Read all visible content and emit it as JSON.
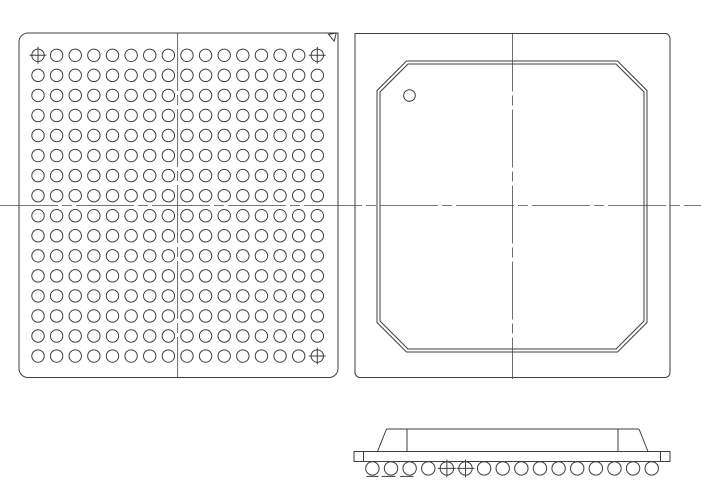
{
  "drawing": {
    "canvas": {
      "width": 701,
      "height": 495,
      "background": "#ffffff"
    },
    "stroke_color": "#3f3f3f",
    "centerline_color": "#4a4a4a",
    "line_width": 1,
    "centerline_width": 0.8,
    "centerline_dash": "58 4 10 4",
    "h_centerline": {
      "y": 205.6,
      "x1": 0,
      "x2": 701
    },
    "bottom_view": {
      "outline": {
        "x1": 19,
        "y1": 33,
        "x2": 338,
        "y2": 377.5,
        "corner_radius": 9,
        "sharp_corner": "tr"
      },
      "pin1_triangle": [
        [
          328.5,
          34.2
        ],
        [
          336.2,
          33.2
        ],
        [
          334.2,
          41.2
        ]
      ],
      "grid": {
        "cols": 16,
        "rows": 16,
        "x0": 38,
        "y0": 55.3,
        "dx": 18.62,
        "dy": 20.05,
        "ball_radius": 6.2
      },
      "crosshair_balls": [
        [
          0,
          0
        ],
        [
          0,
          15
        ],
        [
          15,
          15
        ]
      ],
      "crosshair_overhang": 2.2,
      "v_centerline": {
        "x": 177.65,
        "y1": 33,
        "y2": 377.5
      }
    },
    "top_view": {
      "outline": {
        "x1": 355,
        "y1": 33.5,
        "x2": 670,
        "y2": 377.5,
        "corner_radius": 5,
        "sharp_corner": "tl"
      },
      "mold_octagon_outer": {
        "x1": 377,
        "y1": 61,
        "x2": 647,
        "y2": 352,
        "chamfer": 29.5
      },
      "mold_octagon_inner": {
        "x1": 380,
        "y1": 64,
        "x2": 644,
        "y2": 349,
        "chamfer": 28
      },
      "pin1_dot": {
        "cx": 409.5,
        "cy": 95.5,
        "r": 5.8
      },
      "v_centerline": {
        "x": 512.5,
        "y1": 33.5,
        "y2": 379
      }
    },
    "side_view": {
      "substrate": {
        "x1": 354,
        "y1": 451.5,
        "x2": 670,
        "y2": 461.5
      },
      "substrate_end_lines_x": [
        363.5,
        660.5
      ],
      "mold_top": {
        "y": 429,
        "x1": 386.5,
        "x2": 639
      },
      "mold_slants": [
        [
          377.5,
          451.5,
          386.5,
          429
        ],
        [
          639,
          429,
          648,
          451.5
        ]
      ],
      "mold_edge_lines": [
        [
          407,
          429,
          407,
          451.5
        ],
        [
          618,
          429,
          618,
          451.5
        ]
      ],
      "balls": {
        "count": 16,
        "x0": 372.4,
        "dx": 18.62,
        "cy": 468.4,
        "r": 6.7
      },
      "crosshair_ball_indices": [
        4,
        5
      ],
      "crosshair_overhang": 2.2,
      "seating_dashes": {
        "y": 476.4,
        "segments": [
          [
            366.5,
            378.5
          ],
          [
            381.5,
            395.5
          ],
          [
            400,
            413.5
          ]
        ]
      }
    }
  }
}
